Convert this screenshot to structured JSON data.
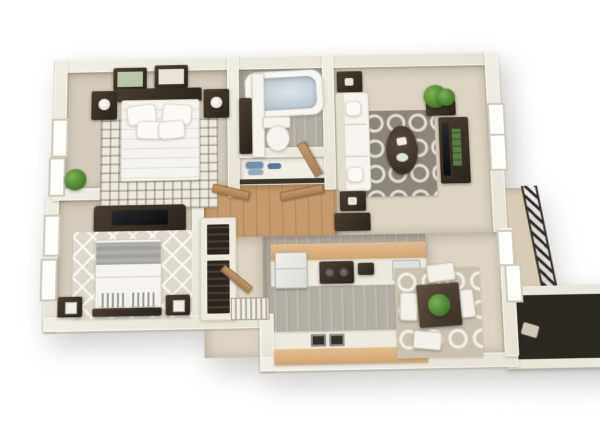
{
  "scene": {
    "title": "3D floor plan render of a one-level two-bedroom apartment, top-down perspective view on white background",
    "background": "#ffffff",
    "palette": {
      "wall": "#edeadf",
      "wall_shadow": "#cfc8b8",
      "carpet_beige": "#d4cbbc",
      "floor_beige": "#dcd3c2",
      "tile_gray": "#b3aea3",
      "wood_hall": "#c59c6c",
      "counter_wood": "#dcb687",
      "rug_gray": "#8b857a",
      "rug_cream": "#eee9dd",
      "rug_greige": "#cbc1b1",
      "furniture_dark": "#3a3128",
      "bedding_white": "#f6f4ee",
      "bedding_gray_stripe": "#a9a8a4",
      "plant_green": "#55903a",
      "towel_blue": "#7396ae",
      "railing_dark": "#2b2723",
      "tub_water": "#bcc7cf"
    }
  },
  "rooms": {
    "bedroom1": {
      "name": "Bedroom 1 (top-left): bed with white bedding, dark headboard, two nightstands with lamps, two framed wall art pieces, cream lattice rug, potted plant, two windows"
    },
    "bathroom": {
      "name": "Bathroom: bathtub, toilet, vanity with dark cabinet, gray tile floor"
    },
    "linen_closet": {
      "name": "Linen closet with folded blue towels on white shelf"
    },
    "hallway": {
      "name": "Hallway with wood floor and open doors"
    },
    "living_room": {
      "name": "Living room: white sofa, two dark end tables, gray trellis rug, oval coffee table, media console with TV and green books, corner plant, desk, window"
    },
    "bedroom2": {
      "name": "Bedroom 2 (left): bed with gray and white striped bedding, media console with TV, diamond-pattern rug, two nightstands, bookshelf, two windows"
    },
    "entry": {
      "name": "Entry corridor with louvered closet door and open door"
    },
    "kitchen": {
      "name": "Kitchen: refrigerator, range with burners, sinks, wood countertops, gray plank tile floor"
    },
    "dining": {
      "name": "Dining area: square dark table with green centerpiece, four white chairs, greige trellis rug"
    },
    "balcony": {
      "name": "Balcony: hatched metal railing, sliding glass door, dark storage closet"
    }
  }
}
